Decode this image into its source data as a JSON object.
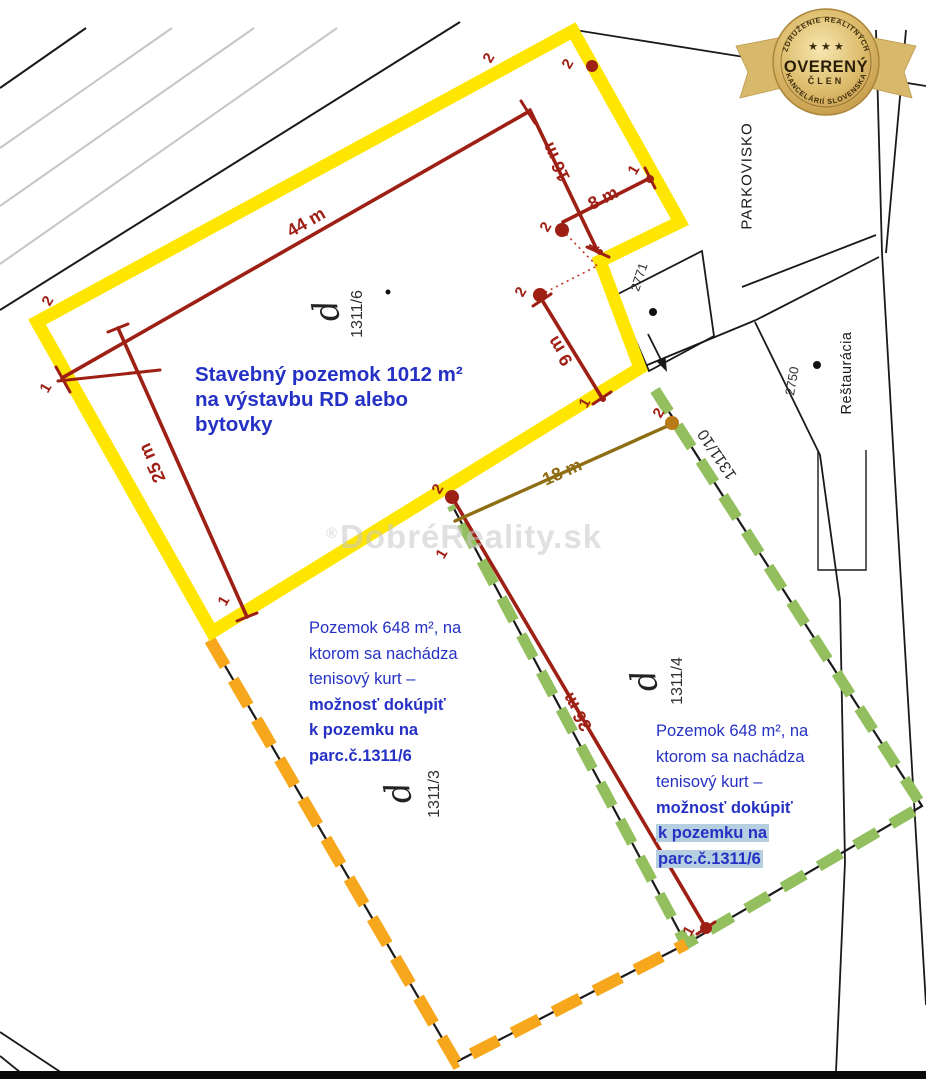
{
  "badge": {
    "arc_top": "ZDRUŽENIE REALITNÝCH",
    "stars": "★ ★ ★",
    "name": "OVERENÝ",
    "member": "ČLEN",
    "arc_bottom": "KANCELÁRIÍ SLOVENSKA"
  },
  "watermark": {
    "symbol": "®",
    "text": "DobréReality.sk"
  },
  "plots": {
    "main": {
      "lines": [
        "Stavebný pozemok 1012 m²",
        "na výstavbu RD alebo",
        "bytovky"
      ]
    },
    "left": {
      "lines": [
        "Pozemok 648 m², na",
        "ktorom sa nachádza",
        "tenisový kurt –",
        "možnosť dokúpiť",
        "k pozemku na",
        "parc.č.1311/6"
      ]
    },
    "right": {
      "lines": [
        "Pozemok 648 m², na",
        "ktorom sa nachádza",
        "tenisový kurt –",
        "možnosť dokúpiť",
        "k pozemku na",
        "parc.č.1311/6"
      ]
    }
  },
  "measurements": {
    "m44": "44 m",
    "m25": "25 m",
    "m16": "16 m",
    "m8": "8 m",
    "m9": "9 m",
    "m18": "18 m",
    "m36": "36 m"
  },
  "parcels": {
    "p1311_6": "1311/6",
    "p1311_3": "1311/3",
    "p1311_4": "1311/4",
    "p1311_10": "1311/10",
    "p2771": "2771",
    "p2750": "2750",
    "land_use_symbol": "d"
  },
  "areas": {
    "parkovisko": "PARKOVISKO",
    "restauracia": "Reštaurácia"
  },
  "survey_points": [
    "2",
    "2",
    "2",
    "1",
    "1",
    "2",
    "1",
    "1",
    "2",
    "1",
    "2",
    "1",
    "2",
    "1"
  ],
  "colors": {
    "plot_main_outline": "#ffe600",
    "plot_left_outline": "#f6a71b",
    "plot_right_outline": "#93bf5e",
    "dimension_red": "#9e2015",
    "dimension_olive": "#8f6d12",
    "annotation_blue": "#2531c4",
    "highlight": "#b5cfe0"
  }
}
